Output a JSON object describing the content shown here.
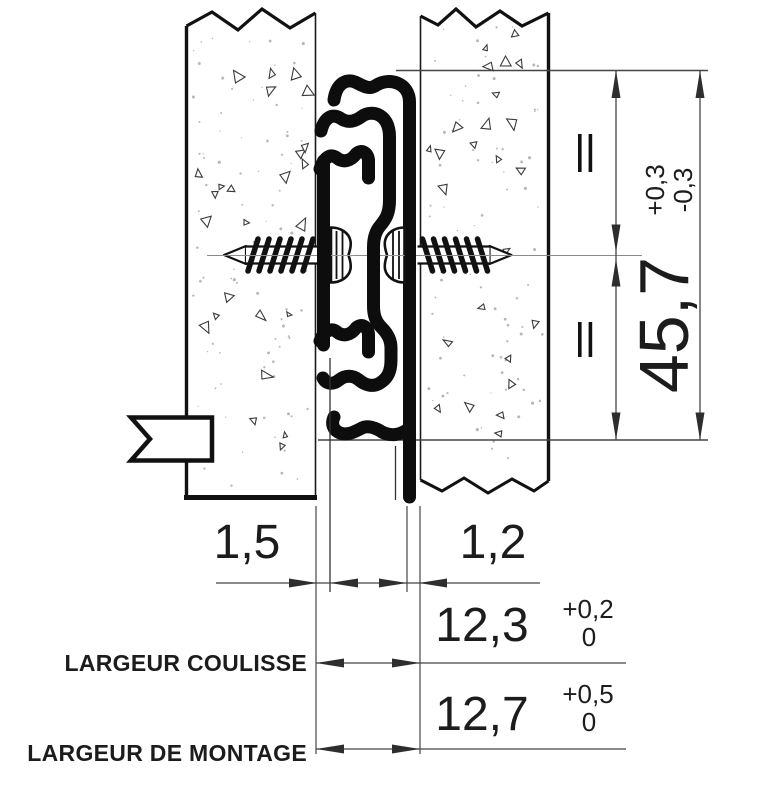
{
  "dimensions": {
    "overall_height": {
      "value": "45,7",
      "tol_plus": "+0,3",
      "tol_minus": "-0,3"
    },
    "rail_left_thickness": {
      "value": "1,5"
    },
    "rail_right_thickness": {
      "value": "1,2"
    },
    "slide_width": {
      "value": "12,3",
      "tol_plus": "+0,2",
      "tol_zero": "0",
      "label": "LARGEUR COULISSE"
    },
    "mounting_width": {
      "value": "12,7",
      "tol_plus": "+0,5",
      "tol_zero": "0",
      "label": "LARGEUR DE MONTAGE"
    }
  },
  "symbols": {
    "equal_mark": "="
  },
  "colors": {
    "outline": "#111111",
    "profile": "#0d0d0d",
    "dim_line": "#454545",
    "centerline": "#8a8a8a",
    "texture": "#3a3a3a"
  }
}
